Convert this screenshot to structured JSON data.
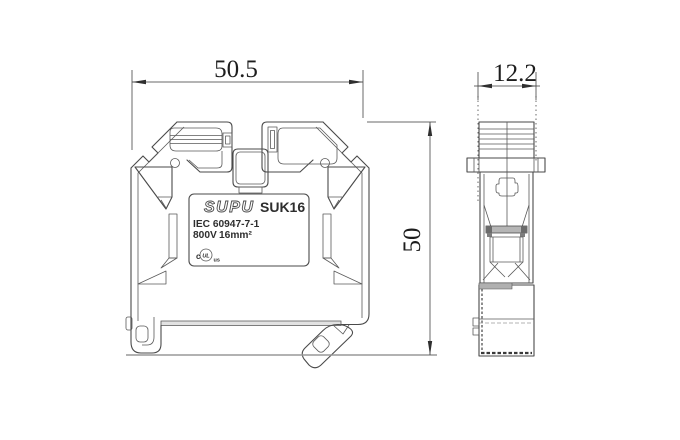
{
  "dims": {
    "width": "50.5",
    "depth": "12.2",
    "height": "50"
  },
  "label": {
    "brand": "SUPU",
    "model": "SUK16",
    "standard": "IEC 60947-7-1",
    "voltage": "800V",
    "wire": "16mm²",
    "cert_c": "c",
    "cert_ul": "UL",
    "cert_us": "us"
  },
  "colors": {
    "line": "#4a4a4a",
    "dimension": "#2f2f2f",
    "ground": "#999999",
    "background": "#ffffff"
  }
}
